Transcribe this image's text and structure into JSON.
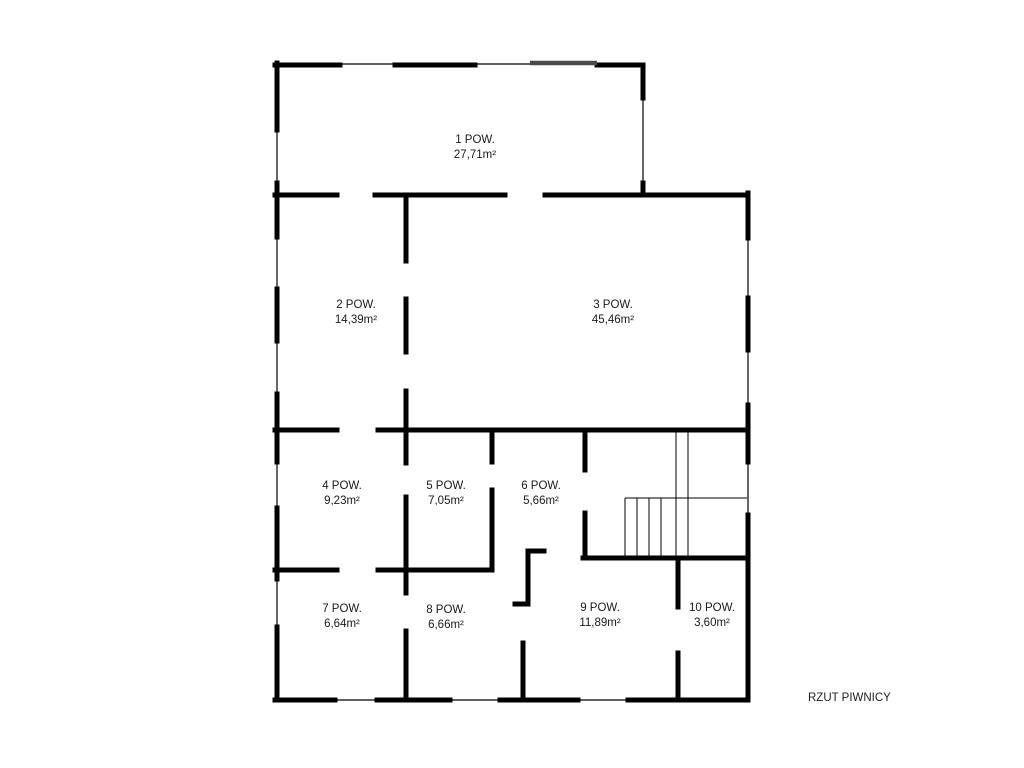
{
  "title": "RZUT PIWNICY",
  "colors": {
    "wall": "#000000",
    "window": "#000000",
    "gray_wall": "#4a4a4a",
    "text": "#1a1a1a",
    "background": "#ffffff"
  },
  "rooms": [
    {
      "number": "1",
      "label": "1 POW.",
      "area": "27,71m²",
      "x": 475,
      "y": 148
    },
    {
      "number": "2",
      "label": "2 POW.",
      "area": "14,39m²",
      "x": 356,
      "y": 313
    },
    {
      "number": "3",
      "label": "3 POW.",
      "area": "45,46m²",
      "x": 613,
      "y": 313
    },
    {
      "number": "4",
      "label": "4 POW.",
      "area": "9,23m²",
      "x": 342,
      "y": 494
    },
    {
      "number": "5",
      "label": "5 POW.",
      "area": "7,05m²",
      "x": 446,
      "y": 494
    },
    {
      "number": "6",
      "label": "6 POW.",
      "area": "5,66m²",
      "x": 541,
      "y": 494
    },
    {
      "number": "7",
      "label": "7 POW.",
      "area": "6,64m²",
      "x": 342,
      "y": 617
    },
    {
      "number": "8",
      "label": "8 POW.",
      "area": "6,66m²",
      "x": 446,
      "y": 618
    },
    {
      "number": "9",
      "label": "9 POW.",
      "area": "11,89m²",
      "x": 600,
      "y": 616
    },
    {
      "number": "10",
      "label": "10 POW.",
      "area": "3,60m²",
      "x": 712,
      "y": 616
    }
  ],
  "plan": {
    "walls_thick": [
      [
        277,
        63,
        277,
        130
      ],
      [
        277,
        183,
        277,
        237
      ],
      [
        277,
        289,
        277,
        341
      ],
      [
        277,
        394,
        277,
        462
      ],
      [
        277,
        508,
        277,
        579
      ],
      [
        277,
        627,
        277,
        700
      ],
      [
        275,
        65,
        340,
        65
      ],
      [
        395,
        65,
        475,
        65
      ],
      [
        597,
        65,
        643,
        65
      ],
      [
        643,
        65,
        643,
        98
      ],
      [
        643,
        183,
        643,
        195
      ],
      [
        275,
        195,
        337,
        195
      ],
      [
        375,
        195,
        505,
        195
      ],
      [
        545,
        195,
        748,
        195
      ],
      [
        748,
        193,
        748,
        238
      ],
      [
        748,
        298,
        748,
        350
      ],
      [
        748,
        405,
        748,
        462
      ],
      [
        748,
        515,
        748,
        700
      ],
      [
        406,
        195,
        406,
        261
      ],
      [
        406,
        299,
        406,
        352
      ],
      [
        406,
        391,
        406,
        430
      ],
      [
        275,
        430,
        337,
        430
      ],
      [
        378,
        430,
        748,
        430
      ],
      [
        406,
        430,
        406,
        463
      ],
      [
        406,
        497,
        406,
        570
      ],
      [
        492,
        430,
        492,
        462
      ],
      [
        492,
        490,
        492,
        570
      ],
      [
        585,
        430,
        585,
        470
      ],
      [
        585,
        513,
        585,
        558
      ],
      [
        275,
        570,
        337,
        570
      ],
      [
        378,
        570,
        492,
        570
      ],
      [
        583,
        558,
        748,
        558
      ],
      [
        528,
        551,
        544,
        551
      ],
      [
        528,
        551,
        528,
        604
      ],
      [
        515,
        604,
        528,
        604
      ],
      [
        523,
        643,
        523,
        700
      ],
      [
        678,
        558,
        678,
        607
      ],
      [
        678,
        653,
        678,
        700
      ],
      [
        406,
        570,
        406,
        593
      ],
      [
        406,
        631,
        406,
        700
      ],
      [
        275,
        700,
        335,
        700
      ],
      [
        377,
        700,
        450,
        700
      ],
      [
        500,
        700,
        578,
        700
      ],
      [
        628,
        700,
        748,
        700
      ]
    ],
    "walls_thin": [
      [
        340,
        64,
        395,
        64
      ],
      [
        475,
        64,
        530,
        64
      ],
      [
        277,
        130,
        277,
        183
      ],
      [
        277,
        237,
        277,
        289
      ],
      [
        277,
        341,
        277,
        394
      ],
      [
        277,
        462,
        277,
        508
      ],
      [
        277,
        579,
        277,
        627
      ],
      [
        643,
        98,
        643,
        183
      ],
      [
        748,
        238,
        748,
        298
      ],
      [
        748,
        350,
        748,
        405
      ],
      [
        748,
        462,
        748,
        515
      ],
      [
        335,
        700,
        377,
        700
      ],
      [
        450,
        700,
        500,
        700
      ],
      [
        578,
        700,
        628,
        700
      ]
    ],
    "walls_gray": [
      [
        530,
        63,
        597,
        63
      ]
    ],
    "stairs": [
      [
        625,
        498,
        747,
        498
      ],
      [
        625,
        498,
        625,
        558
      ],
      [
        637,
        498,
        637,
        558
      ],
      [
        649,
        498,
        649,
        558
      ],
      [
        661,
        498,
        661,
        558
      ],
      [
        676,
        430,
        676,
        558
      ],
      [
        688,
        430,
        688,
        558
      ]
    ]
  }
}
